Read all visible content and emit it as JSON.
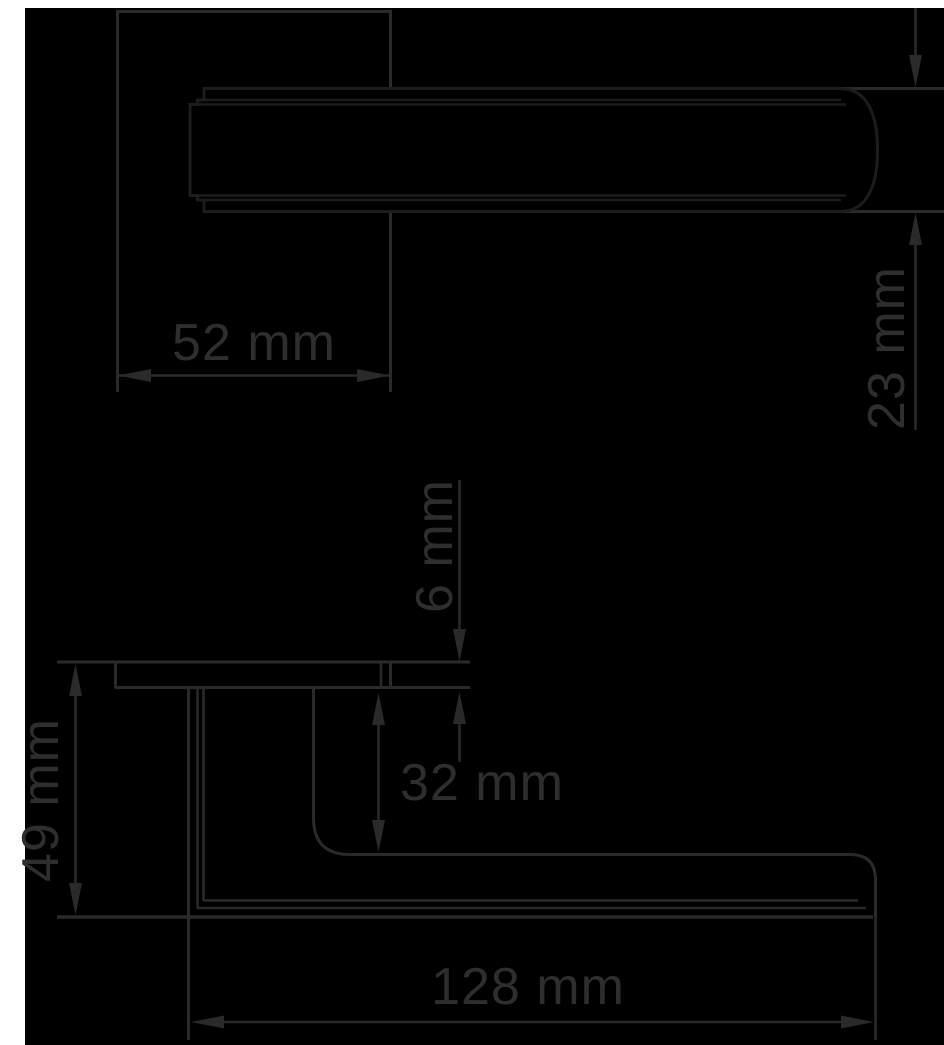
{
  "drawing": {
    "subject": "door lever handle dimension drawing",
    "views": [
      "plan-view-top",
      "side-elevation-bottom"
    ],
    "colors": {
      "background": "#000000",
      "margin": "#ffffff",
      "line_ink": "#2a2a2a",
      "handle_outline": "#1c1c1c",
      "handle_fill": "#ffffff",
      "label_text": "#2e2e2e"
    }
  },
  "dimensions": {
    "rose_width": {
      "label": "52 mm",
      "value": 52,
      "unit": "mm",
      "orientation": "horizontal",
      "view": "plan"
    },
    "lever_thickness": {
      "label": "23 mm",
      "value": 23,
      "unit": "mm",
      "orientation": "vertical",
      "view": "plan"
    },
    "rose_thickness": {
      "label": "6 mm",
      "value": 6,
      "unit": "mm",
      "orientation": "vertical",
      "view": "side"
    },
    "grip_clearance": {
      "label": "32 mm",
      "value": 32,
      "unit": "mm",
      "orientation": "vertical",
      "view": "side"
    },
    "projection": {
      "label": "49 mm",
      "value": 49,
      "unit": "mm",
      "orientation": "vertical",
      "view": "side"
    },
    "lever_length": {
      "label": "128 mm",
      "value": 128,
      "unit": "mm",
      "orientation": "horizontal",
      "view": "side"
    }
  }
}
